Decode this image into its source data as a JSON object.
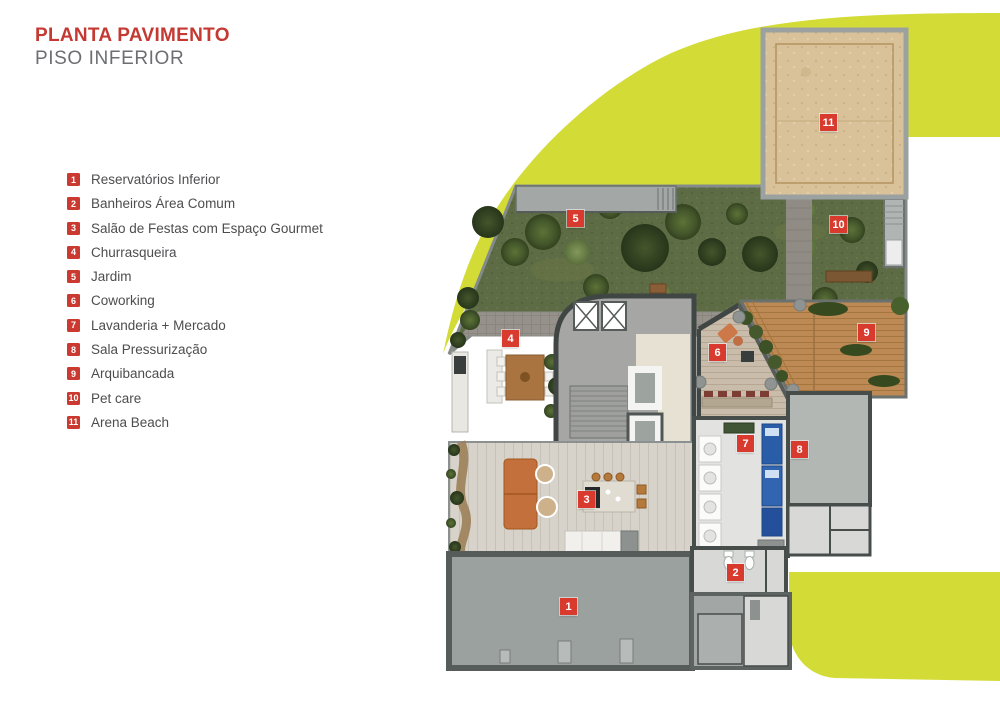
{
  "header": {
    "title": "PLANTA PAVIMENTO",
    "subtitle": "PISO INFERIOR"
  },
  "legend": {
    "items": [
      {
        "number": "1",
        "label": "Reservatórios Inferior"
      },
      {
        "number": "2",
        "label": "Banheiros Área Comum"
      },
      {
        "number": "3",
        "label": "Salão de Festas com Espaço Gourmet"
      },
      {
        "number": "4",
        "label": "Churrasqueira"
      },
      {
        "number": "5",
        "label": "Jardim"
      },
      {
        "number": "6",
        "label": "Coworking"
      },
      {
        "number": "7",
        "label": "Lavanderia + Mercado"
      },
      {
        "number": "8",
        "label": "Sala Pressurização"
      },
      {
        "number": "9",
        "label": "Arquibancada"
      },
      {
        "number": "10",
        "label": "Pet care"
      },
      {
        "number": "11",
        "label": "Arena Beach"
      }
    ]
  },
  "colors": {
    "accent_lime": "#d3dc37",
    "marker_red": "#d93a2e",
    "legend_red": "#cb3a31",
    "title_red": "#c53933",
    "subtitle_gray": "#6d6e71",
    "legend_text": "#4d4d4f",
    "sand": "#d9c29a",
    "grass": "#5d6c44",
    "deck_wood": "#bd8a55"
  }
}
